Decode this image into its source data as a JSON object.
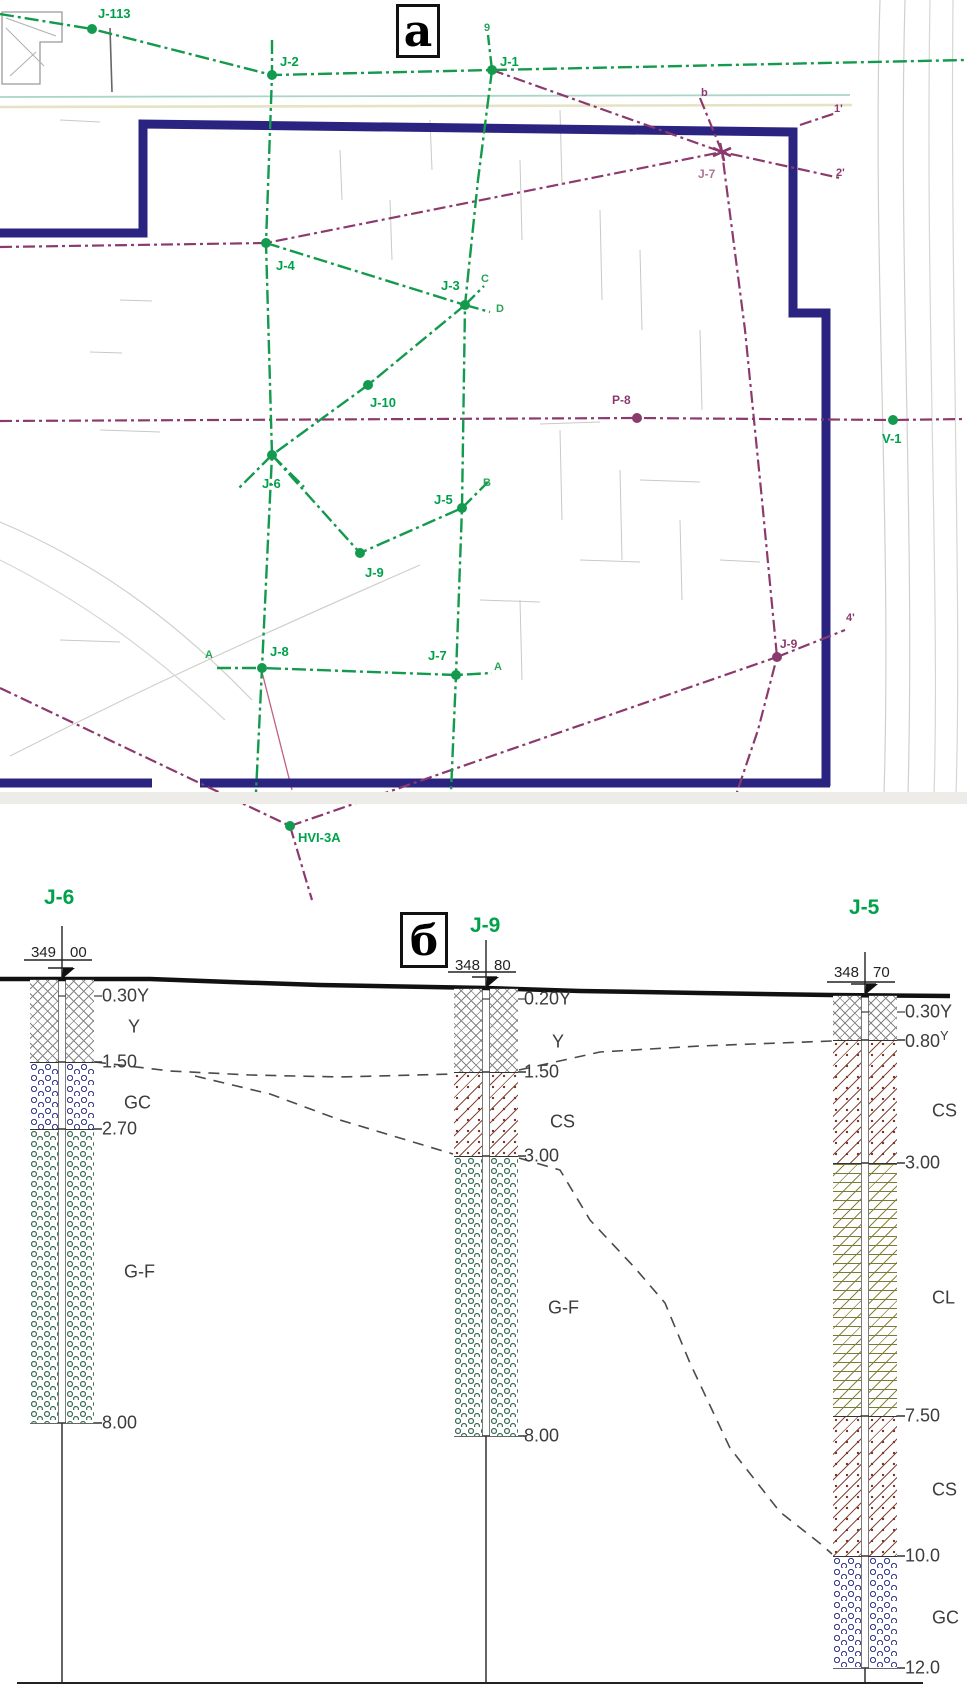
{
  "figure": {
    "panel_a_label": "a",
    "panel_b_label": "б"
  },
  "colors": {
    "survey_green": "#149a4e",
    "label_green": "#00a14b",
    "traverse_purple": "#8c3a6e",
    "building_navy": "#2b2380",
    "topo_gray": "#c9c9c6",
    "teal_line": "#abd5c5",
    "cream_line": "#e6e2c4",
    "section_text": "#3c3c3c",
    "ground_black": "#111111",
    "soil_fill_gray": "#858585",
    "soil_gc_blue": "#3b3f92",
    "soil_gf_green": "#3f7059",
    "soil_cs_brown": "#8a4538",
    "soil_cl_olive": "#80803a"
  },
  "map": {
    "green_nodes": [
      {
        "label": "J-113",
        "x": 92,
        "y": 29,
        "lx": 98,
        "ly": 18
      },
      {
        "label": "J-2",
        "x": 272,
        "y": 75,
        "lx": 280,
        "ly": 66
      },
      {
        "label": "J-1",
        "x": 492,
        "y": 70,
        "lx": 500,
        "ly": 66
      },
      {
        "label": "J-4",
        "x": 266,
        "y": 243,
        "lx": 276,
        "ly": 270
      },
      {
        "label": "J-3",
        "x": 465,
        "y": 305,
        "lx": 441,
        "ly": 290
      },
      {
        "label": "J-10",
        "x": 368,
        "y": 385,
        "lx": 370,
        "ly": 407
      },
      {
        "label": "J-6",
        "x": 272,
        "y": 455,
        "lx": 262,
        "ly": 488
      },
      {
        "label": "J-5",
        "x": 462,
        "y": 508,
        "lx": 434,
        "ly": 504
      },
      {
        "label": "J-9",
        "x": 360,
        "y": 553,
        "lx": 365,
        "ly": 577
      },
      {
        "label": "J-8",
        "x": 262,
        "y": 668,
        "lx": 270,
        "ly": 656
      },
      {
        "label": "J-7",
        "x": 456,
        "y": 675,
        "lx": 428,
        "ly": 660
      },
      {
        "label": "HVI-3A",
        "x": 290,
        "y": 826,
        "lx": 298,
        "ly": 842
      },
      {
        "label": "V-1",
        "x": 893,
        "y": 420,
        "lx": 882,
        "ly": 443
      }
    ],
    "purple_nodes": [
      {
        "label": "P-8",
        "x": 637,
        "y": 418,
        "lx": 612,
        "ly": 404,
        "star": false
      },
      {
        "label": "J-9",
        "x": 777,
        "y": 657,
        "lx": 780,
        "ly": 648,
        "star": false
      },
      {
        "label": "J-7",
        "x": 722,
        "y": 152,
        "lx": 698,
        "ly": 178,
        "star": true
      }
    ],
    "aux_labels": [
      {
        "t": "C",
        "x": 481,
        "y": 282,
        "c": "green"
      },
      {
        "t": "D",
        "x": 496,
        "y": 312,
        "c": "green"
      },
      {
        "t": "B",
        "x": 483,
        "y": 486,
        "c": "green"
      },
      {
        "t": "A",
        "x": 205,
        "y": 658,
        "c": "green"
      },
      {
        "t": "A",
        "x": 494,
        "y": 670,
        "c": "green"
      },
      {
        "t": "9",
        "x": 484,
        "y": 31,
        "c": "green"
      },
      {
        "t": "b",
        "x": 701,
        "y": 96,
        "c": "purple"
      },
      {
        "t": "1'",
        "x": 834,
        "y": 112,
        "c": "purple"
      },
      {
        "t": "2'",
        "x": 836,
        "y": 176,
        "c": "purple"
      },
      {
        "t": "4'",
        "x": 846,
        "y": 621,
        "c": "purple"
      }
    ],
    "green_lines": [
      [
        [
          0,
          14
        ],
        [
          92,
          29
        ],
        [
          272,
          75
        ],
        [
          492,
          70
        ],
        [
          966,
          60
        ]
      ],
      [
        [
          272,
          40
        ],
        [
          272,
          75
        ],
        [
          266,
          243
        ],
        [
          272,
          455
        ],
        [
          262,
          668
        ],
        [
          256,
          792
        ]
      ],
      [
        [
          492,
          70
        ],
        [
          478,
          180
        ],
        [
          465,
          305
        ],
        [
          462,
          508
        ],
        [
          456,
          675
        ],
        [
          451,
          792
        ]
      ],
      [
        [
          266,
          243
        ],
        [
          465,
          305
        ]
      ],
      [
        [
          465,
          305
        ],
        [
          368,
          385
        ],
        [
          272,
          455
        ]
      ],
      [
        [
          272,
          455
        ],
        [
          360,
          553
        ],
        [
          462,
          508
        ]
      ],
      [
        [
          217,
          668
        ],
        [
          262,
          668
        ],
        [
          456,
          675
        ],
        [
          492,
          673
        ]
      ],
      [
        [
          462,
          508
        ],
        [
          488,
          482
        ]
      ],
      [
        [
          465,
          305
        ],
        [
          484,
          286
        ]
      ],
      [
        [
          465,
          305
        ],
        [
          490,
          312
        ]
      ],
      [
        [
          272,
          455
        ],
        [
          238,
          489
        ]
      ],
      [
        [
          272,
          455
        ],
        [
          304,
          487
        ]
      ],
      [
        [
          492,
          70
        ],
        [
          488,
          35
        ]
      ]
    ],
    "purple_lines": [
      [
        [
          0,
          421
        ],
        [
          637,
          418
        ],
        [
          893,
          420
        ],
        [
          966,
          419
        ]
      ],
      [
        [
          492,
          70
        ],
        [
          722,
          152
        ],
        [
          840,
          178
        ]
      ],
      [
        [
          700,
          98
        ],
        [
          722,
          152
        ],
        [
          745,
          330
        ],
        [
          762,
          500
        ],
        [
          777,
          657
        ],
        [
          758,
          730
        ],
        [
          736,
          795
        ]
      ],
      [
        [
          290,
          826
        ],
        [
          777,
          657
        ]
      ],
      [
        [
          777,
          657
        ],
        [
          845,
          630
        ]
      ],
      [
        [
          0,
          688
        ],
        [
          290,
          826
        ],
        [
          312,
          900
        ]
      ],
      [
        [
          0,
          247
        ],
        [
          266,
          243
        ],
        [
          722,
          152
        ]
      ],
      [
        [
          800,
          125
        ],
        [
          836,
          113
        ]
      ]
    ],
    "building_walls": [
      [
        [
          0,
          233
        ],
        [
          143,
          233
        ],
        [
          143,
          124
        ],
        [
          793,
          132
        ],
        [
          793,
          313
        ],
        [
          826,
          313
        ],
        [
          826,
          786
        ]
      ],
      [
        [
          0,
          783
        ],
        [
          152,
          783
        ]
      ],
      [
        [
          200,
          783
        ],
        [
          830,
          783
        ]
      ]
    ],
    "topo_paths": [
      {
        "d": "M0,97 L850,95",
        "c": "#abd5c5",
        "w": 1.8
      },
      {
        "d": "M0,107 L852,105",
        "c": "#e6e2c4",
        "w": 2.6
      },
      {
        "d": "M880,0 C872,260 892,520 884,795",
        "c": "#cfcfcb",
        "w": 1.2
      },
      {
        "d": "M905,0 C898,260 915,520 908,795",
        "c": "#cfcfcb",
        "w": 1.2
      },
      {
        "d": "M930,0 C925,300 940,600 934,795",
        "c": "#d6d6d2",
        "w": 1.2
      },
      {
        "d": "M953,0 C950,300 962,600 956,795",
        "c": "#d6d6d2",
        "w": 1.2
      },
      {
        "d": "M10,756 C120,700 230,648 420,565",
        "c": "#cfcfcb",
        "w": 1.2
      },
      {
        "d": "M0,522 C90,560 170,615 252,700",
        "c": "#cfcfcb",
        "w": 1.2
      },
      {
        "d": "M0,560 C80,600 150,650 225,720",
        "c": "#d6d6d2",
        "w": 1.2
      },
      {
        "d": "M2,12 L62,12 L62,42 L40,42 L40,84 L2,84 Z",
        "c": "#9a9a9a",
        "w": 1.3
      },
      {
        "d": "M6,18 L56,36 M6,28 L44,66 M10,76 L36,52",
        "c": "#b0b0b0",
        "w": 1
      },
      {
        "d": "M110,28 L112,92",
        "c": "#666666",
        "w": 1.6
      },
      {
        "d": "M120,300 L152,301 M90,352 L122,353 M100,430 L160,432 M60,640 L120,642 M480,600 L540,602 M580,560 L640,562 M640,480 L700,482 M720,560 L760,562 M60,120 L100,122 M540,424 L600,422",
        "c": "#c9c9c6",
        "w": 1
      },
      {
        "d": "M520,160 L522,240 M560,110 L562,185 M600,210 L602,300 M640,250 L642,330 M700,330 L702,410 M560,430 L562,520 M620,470 L622,560 M680,520 L682,600 M520,600 L522,680 M340,150 L342,200 M390,200 L392,260 M430,120 L432,170",
        "c": "#c9c9c6",
        "w": 1
      },
      {
        "d": "M262,672 L292,790",
        "c": "#c06080",
        "w": 1.3
      }
    ]
  },
  "section": {
    "ground_line": [
      [
        0,
        979
      ],
      [
        150,
        979
      ],
      [
        230,
        982
      ],
      [
        320,
        985
      ],
      [
        486,
        988
      ],
      [
        580,
        991
      ],
      [
        700,
        993
      ],
      [
        830,
        995
      ],
      [
        950,
        996
      ]
    ],
    "baseline": [
      [
        17,
        1683
      ],
      [
        923,
        1683
      ]
    ],
    "correlation_lines": [
      [
        [
          95,
          1062
        ],
        [
          170,
          1071
        ],
        [
          250,
          1075
        ],
        [
          340,
          1077
        ],
        [
          453,
          1074
        ]
      ],
      [
        [
          519,
          1070
        ],
        [
          600,
          1052
        ],
        [
          700,
          1046
        ],
        [
          832,
          1041
        ]
      ],
      [
        [
          195,
          1076
        ],
        [
          270,
          1094
        ],
        [
          340,
          1120
        ],
        [
          453,
          1154
        ]
      ],
      [
        [
          519,
          1158
        ],
        [
          560,
          1170
        ],
        [
          590,
          1220
        ],
        [
          635,
          1268
        ],
        [
          665,
          1303
        ],
        [
          690,
          1363
        ],
        [
          730,
          1448
        ],
        [
          780,
          1512
        ],
        [
          822,
          1545
        ],
        [
          832,
          1554
        ]
      ]
    ],
    "boreholes": [
      {
        "name": "J-6",
        "cx": 62,
        "ground": 979,
        "bottom": 1423,
        "stick_bottom": 1683,
        "name_x": 44,
        "name_y": 886,
        "elev_left": "349",
        "elev_right": "00",
        "elev_text_y": 953,
        "underline_y": 960,
        "marker_top": 926,
        "halves": [
          [
            30,
            58
          ],
          [
            66,
            94
          ]
        ],
        "layers": [
          {
            "code": "Y",
            "top": 979,
            "bot": 1062
          },
          {
            "code": "GC",
            "top": 1062,
            "bot": 1129
          },
          {
            "code": "GF",
            "top": 1129,
            "bot": 1423
          }
        ],
        "shallow_tick": {
          "t": "0.30Y",
          "y": 996
        },
        "ticks": [
          {
            "t": "1.50",
            "y": 1062
          },
          {
            "t": "2.70",
            "y": 1129
          },
          {
            "t": "8.00",
            "y": 1423
          }
        ],
        "codes": [
          {
            "t": "Y",
            "x": 128,
            "y": 1027
          },
          {
            "t": "GC",
            "x": 124,
            "y": 1103
          },
          {
            "t": "G-F",
            "x": 124,
            "y": 1272
          }
        ],
        "label_x": 102
      },
      {
        "name": "J-9",
        "cx": 486,
        "ground": 988,
        "bottom": 1436,
        "stick_bottom": 1683,
        "name_x": 470,
        "name_y": 914,
        "elev_left": "348",
        "elev_right": "80",
        "elev_text_y": 966,
        "underline_y": 972,
        "marker_top": 940,
        "halves": [
          [
            454,
            482
          ],
          [
            490,
            518
          ]
        ],
        "layers": [
          {
            "code": "Y",
            "top": 988,
            "bot": 1072
          },
          {
            "code": "CS",
            "top": 1072,
            "bot": 1156
          },
          {
            "code": "GF",
            "top": 1156,
            "bot": 1436
          }
        ],
        "shallow_tick": {
          "t": "0.20Y",
          "y": 999
        },
        "ticks": [
          {
            "t": "1.50",
            "y": 1072
          },
          {
            "t": "3.00",
            "y": 1156
          },
          {
            "t": "8.00",
            "y": 1436
          }
        ],
        "codes": [
          {
            "t": "Y",
            "x": 552,
            "y": 1042
          },
          {
            "t": "CS",
            "x": 550,
            "y": 1122
          },
          {
            "t": "G-F",
            "x": 548,
            "y": 1308
          }
        ],
        "label_x": 524
      },
      {
        "name": "J-5",
        "cx": 865,
        "ground": 995,
        "bottom": 1668,
        "stick_bottom": 1683,
        "name_x": 849,
        "name_y": 896,
        "elev_left": "348",
        "elev_right": "70",
        "elev_text_y": 973,
        "underline_y": 982,
        "marker_top": 952,
        "halves": [
          [
            833,
            861
          ],
          [
            869,
            897
          ]
        ],
        "layers": [
          {
            "code": "Y",
            "top": 995,
            "bot": 1040
          },
          {
            "code": "CS",
            "top": 1040,
            "bot": 1163
          },
          {
            "code": "CL",
            "top": 1163,
            "bot": 1416
          },
          {
            "code": "CS",
            "top": 1416,
            "bot": 1556
          },
          {
            "code": "GC",
            "top": 1556,
            "bot": 1668
          }
        ],
        "shallow_tick": {
          "t": "0.30Y",
          "y": 1012
        },
        "ticks": [
          {
            "t": "0.80",
            "sup": "Y",
            "y": 1040
          },
          {
            "t": "3.00",
            "y": 1163
          },
          {
            "t": "7.50",
            "y": 1416
          },
          {
            "t": "10.0",
            "y": 1556
          },
          {
            "t": "12.0",
            "y": 1668
          }
        ],
        "codes": [
          {
            "t": "CS",
            "x": 932,
            "y": 1111
          },
          {
            "t": "CL",
            "x": 932,
            "y": 1298
          },
          {
            "t": "CS",
            "x": 932,
            "y": 1490
          },
          {
            "t": "GC",
            "x": 932,
            "y": 1618
          }
        ],
        "label_x": 905
      }
    ]
  }
}
